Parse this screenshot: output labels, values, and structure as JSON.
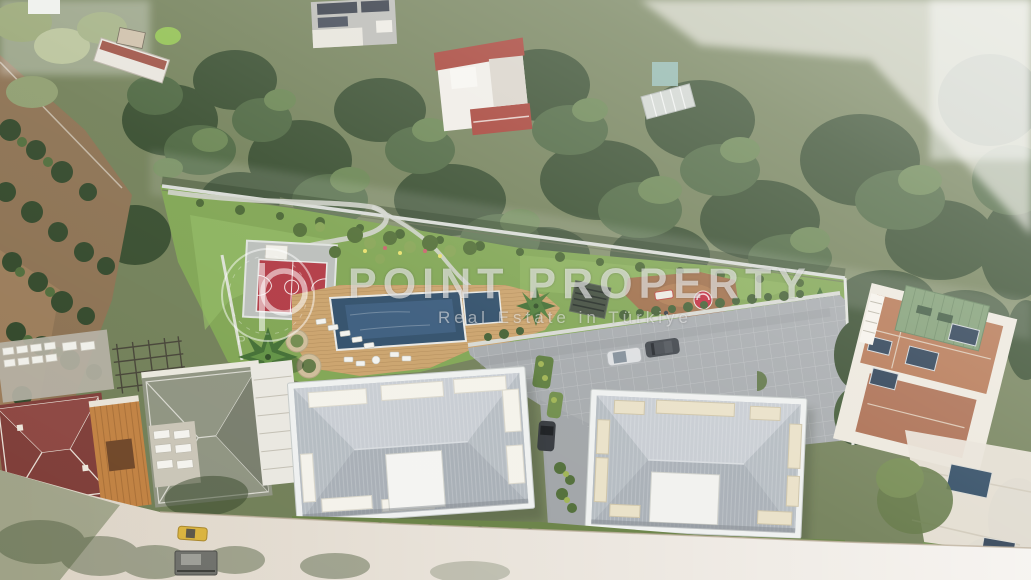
{
  "watermark": {
    "logo_letter": "P",
    "title": "POINT PROPERTY",
    "subtitle": "Real Estate in Türkiye"
  },
  "palette": {
    "lawn": "#7da34f",
    "pool_water": "#2b4a66",
    "sport_court": "#b03540",
    "wood_deck": "#c9a068",
    "paving": "#a4a8ab",
    "playground_ground": "#9c6a44",
    "roof_gray": "#b9bfc6",
    "forest_green": "#33492a",
    "road_dust": "#d9cfc0",
    "terracotta_roof": "#b3724d",
    "watermark_white": "#ffffff"
  },
  "scene": {
    "type": "aerial-drone-photo-with-architectural-render",
    "elements": [
      "forest-hillside",
      "fruit-orchard",
      "landscaped-garden",
      "basketball-court",
      "swimming-pool",
      "kids-pool",
      "wooden-pool-deck",
      "sun-loungers",
      "palm-trees",
      "pergola",
      "playground",
      "parking-lot",
      "parked-cars",
      "apartment-block-a",
      "apartment-block-b",
      "neighboring-houses",
      "access-road",
      "construction-vehicles"
    ]
  }
}
